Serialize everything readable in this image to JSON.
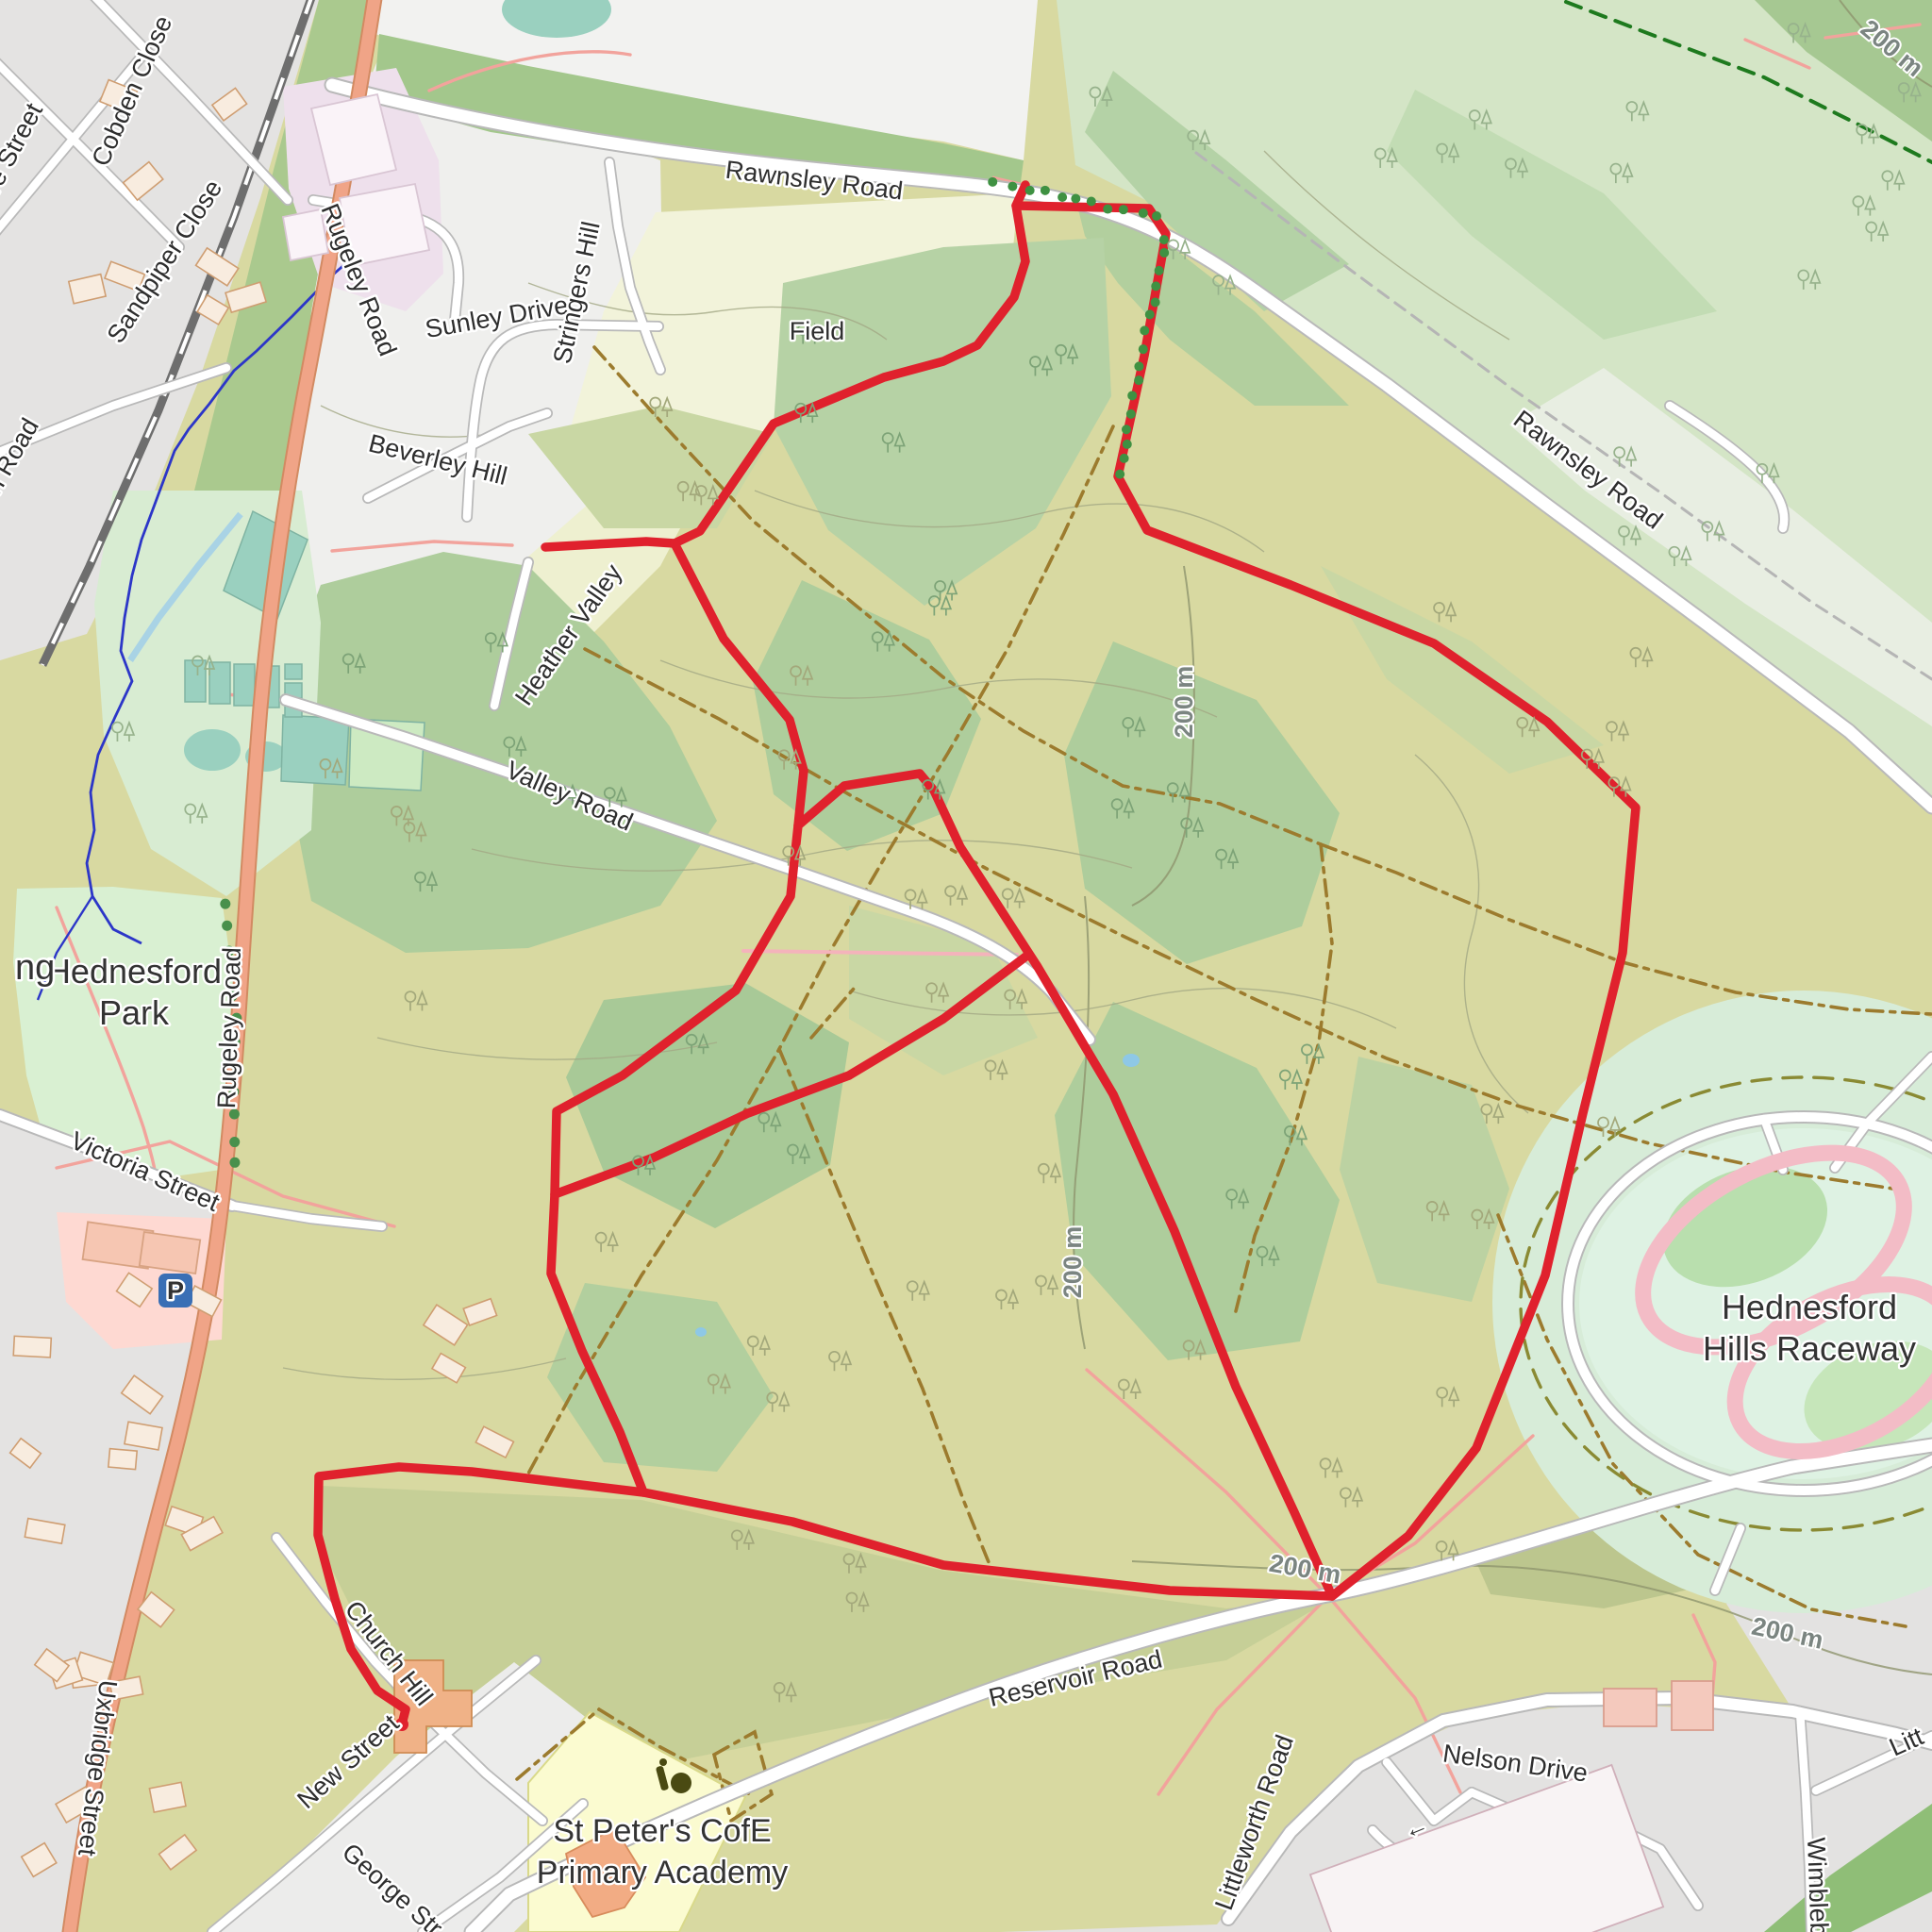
{
  "map": {
    "type": "openstreetmap-style topo map with GPS route overlay",
    "labels": {
      "cobden_close": "Cobden Close",
      "sandpiper_close": "Sandpiper Close",
      "ore_street_partial": "ore Street",
      "n_road_partial": "n Road",
      "rugeley_road": "Rugeley Road",
      "rawnsley_road": "Rawnsley Road",
      "sunley_drive": "Sunley Drive",
      "stringers_hill": "Stringers Hill",
      "beverley_hill": "Beverley Hill",
      "field": "Field",
      "heather_valley": "Heather Valley",
      "valley_road": "Valley Road",
      "hednesford_park_line1": "Hednesford",
      "hednesford_park_line2": "Park",
      "ng_partial": "ng",
      "victoria_street": "Victoria Street",
      "parking_symbol": "P",
      "uxbridge_street": "Uxbridge Street",
      "church_hill": "Church Hill",
      "new_street": "New Street",
      "george_street_partial": "George Str",
      "st_peters_line1": "St Peter's CofE",
      "st_peters_line2": "Primary Academy",
      "reservoir_road": "Reservoir Road",
      "nelson_drive": "Nelson Drive",
      "littleworth_road": "Littleworth Road",
      "littleworth_partial": "Litt",
      "wimblebury_partial": "Wimblebu",
      "raceway_line1": "Hednesford",
      "raceway_line2": "Hills Raceway",
      "contour_200m": "200 m"
    },
    "route": {
      "color": "#e0212d",
      "style": "solid thick GPS track with rounded end cap"
    },
    "colors": {
      "heath": "#d8d9a1",
      "wood": "#aecd9c",
      "pale_wood": "#d4e5c6",
      "park": "#d9f0d2",
      "field": "#f2f3da",
      "residential": "#e3e2e1",
      "school": "#fbfbd0",
      "pitch": "#9ad0bf",
      "primary_road": "#f0a487",
      "path_pink": "#f2a39c",
      "path_dashed": "#9c7b2e",
      "water": "#2c36c8",
      "raceway_track": "#f3bcc6",
      "parking_blue": "#3a6fb5"
    }
  }
}
